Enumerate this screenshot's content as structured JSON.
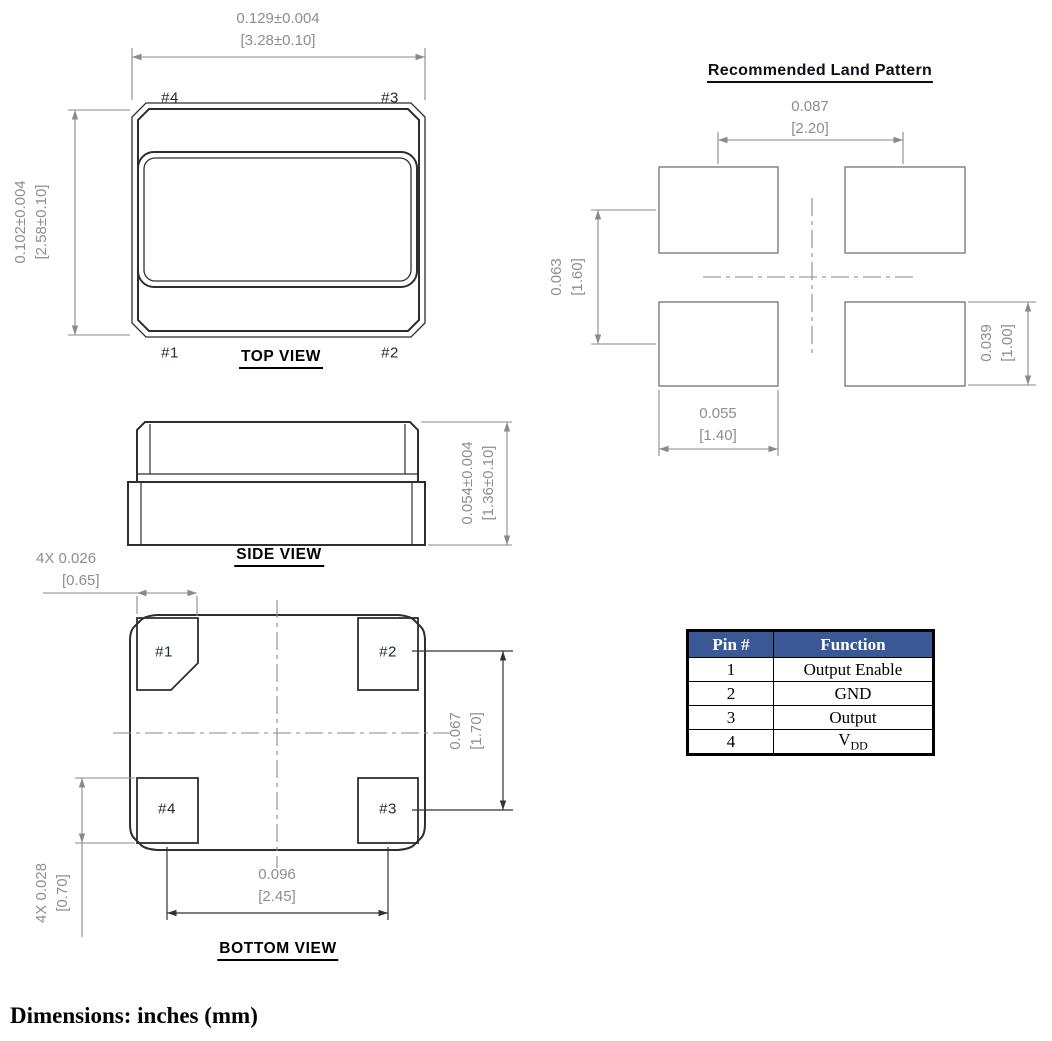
{
  "colors": {
    "table_header_bg": "#3a5796",
    "table_header_text": "#ffffff",
    "dim_text": "#8e8e8e",
    "outline_dark": "#2e2e2e",
    "dim_line_gray": "#8a8a8a",
    "pin_label": "#232b3a"
  },
  "top_view": {
    "title": "TOP VIEW",
    "width_dim": {
      "inches": "0.129±0.004",
      "mm": "[3.28±0.10]"
    },
    "height_dim": {
      "inches": "0.102±0.004",
      "mm": "[2.58±0.10]"
    },
    "pin_top_left": "#4",
    "pin_top_right": "#3",
    "pin_bottom_left": "#1",
    "pin_bottom_right": "#2"
  },
  "side_view": {
    "title": "SIDE VIEW",
    "height_dim": {
      "inches": "0.054±0.004",
      "mm": "[1.36±0.10]"
    }
  },
  "bottom_view": {
    "title": "BOTTOM VIEW",
    "pad_width_dim": {
      "inches": "4X 0.026",
      "mm": "[0.65]"
    },
    "pad_height_dim": {
      "inches": "4X 0.028",
      "mm": "[0.70]"
    },
    "pad_pitch_x_dim": {
      "inches": "0.096",
      "mm": "[2.45]"
    },
    "pad_pitch_y_dim": {
      "inches": "0.067",
      "mm": "[1.70]"
    },
    "pin_top_left": "#1",
    "pin_top_right": "#2",
    "pin_bottom_left": "#4",
    "pin_bottom_right": "#3"
  },
  "land_pattern": {
    "title": "Recommended Land Pattern",
    "pitch_x_dim": {
      "inches": "0.087",
      "mm": "[2.20]"
    },
    "pitch_y_dim": {
      "inches": "0.063",
      "mm": "[1.60]"
    },
    "pad_width_dim": {
      "inches": "0.055",
      "mm": "[1.40]"
    },
    "pad_height_dim": {
      "inches": "0.039",
      "mm": "[1.00]"
    }
  },
  "pin_table": {
    "headers": [
      "Pin #",
      "Function"
    ],
    "rows": [
      [
        "1",
        "Output Enable"
      ],
      [
        "2",
        "GND"
      ],
      [
        "3",
        "Output"
      ],
      [
        "4",
        "V"
      ]
    ],
    "vdd_subscript": "DD"
  },
  "footer": {
    "note": "Dimensions: inches (mm)"
  }
}
